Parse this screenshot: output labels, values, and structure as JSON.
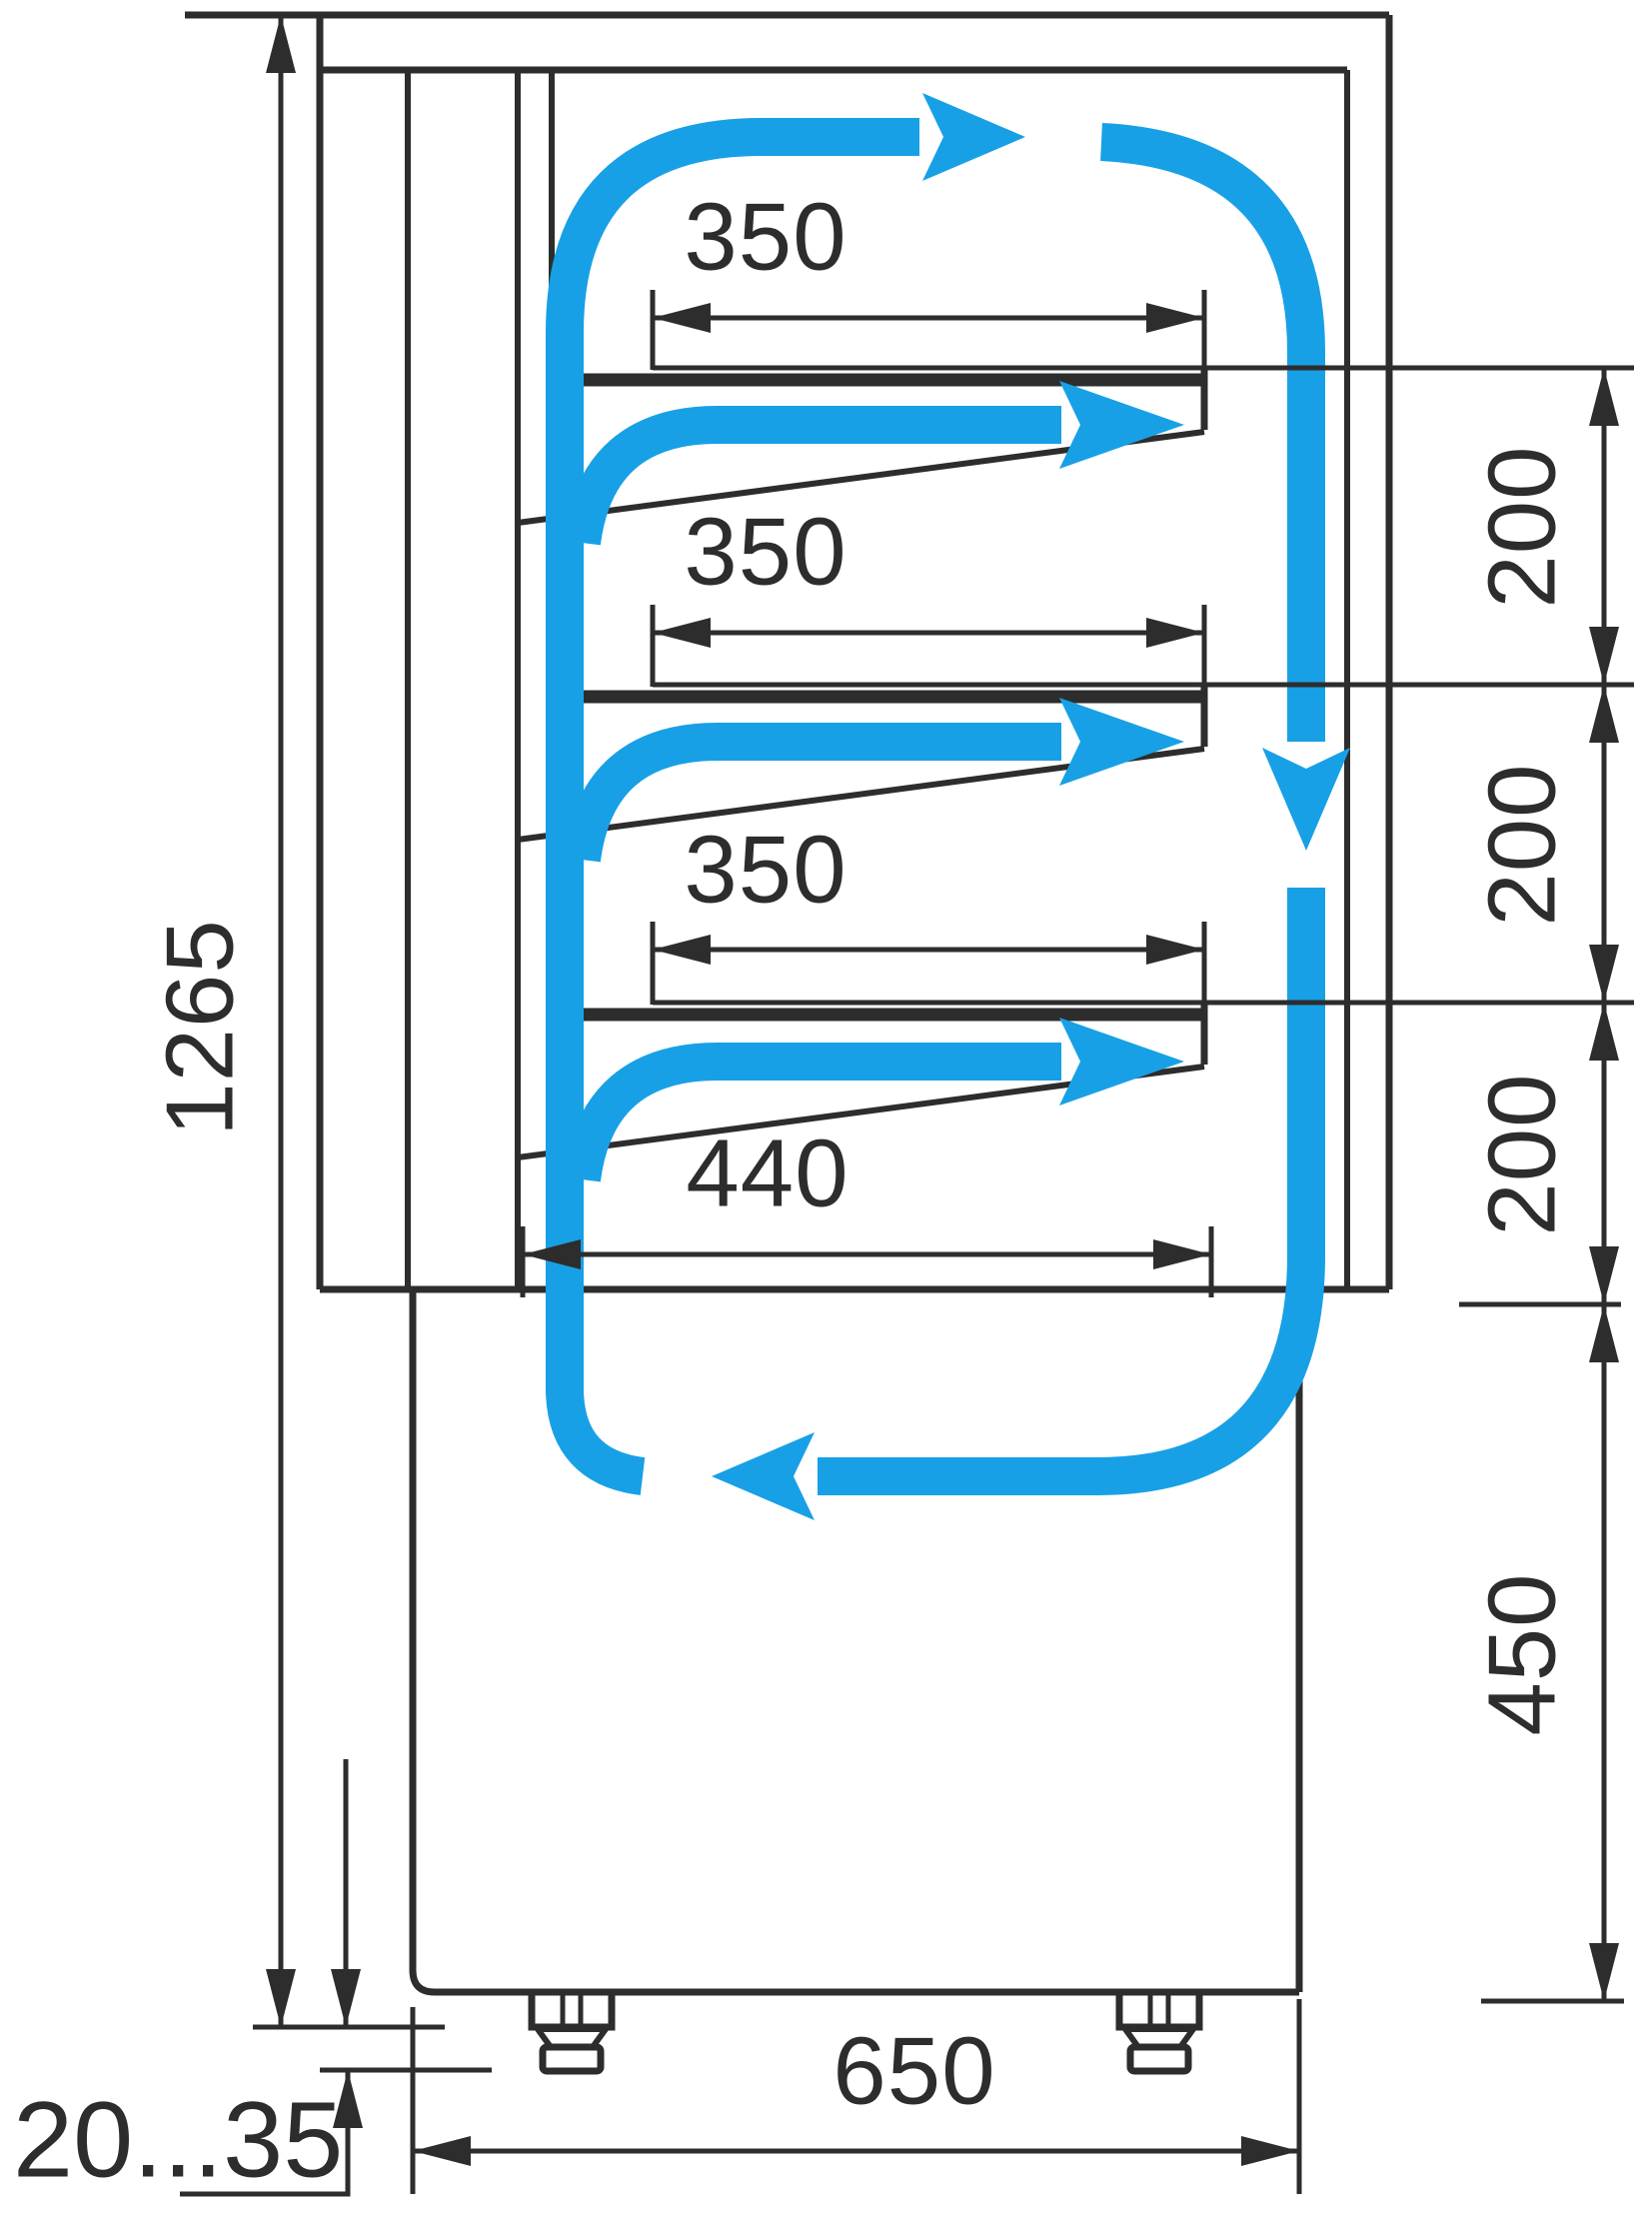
{
  "diagram": {
    "type": "technical-dimension-drawing",
    "subject": "Refrigerated pastry display case, side section view with circulating air flow",
    "units": "mm"
  },
  "colors": {
    "line": "#2d2d2d",
    "flow": "#18a0e6",
    "background": "#ffffff"
  },
  "labels": {
    "overall_height": "1265",
    "shelf1_width": "350",
    "shelf2_width": "350",
    "shelf3_width": "350",
    "deck_width": "440",
    "gap1": "200",
    "gap2": "200",
    "gap3": "200",
    "base_height": "450",
    "depth": "650",
    "foot_adjust_range": "20...35"
  },
  "airflow": {
    "pattern": "closed loop: up rear duct, across top, down front glass, back along base, plus three outlet arrows over shelves",
    "arrow_count": 6
  }
}
